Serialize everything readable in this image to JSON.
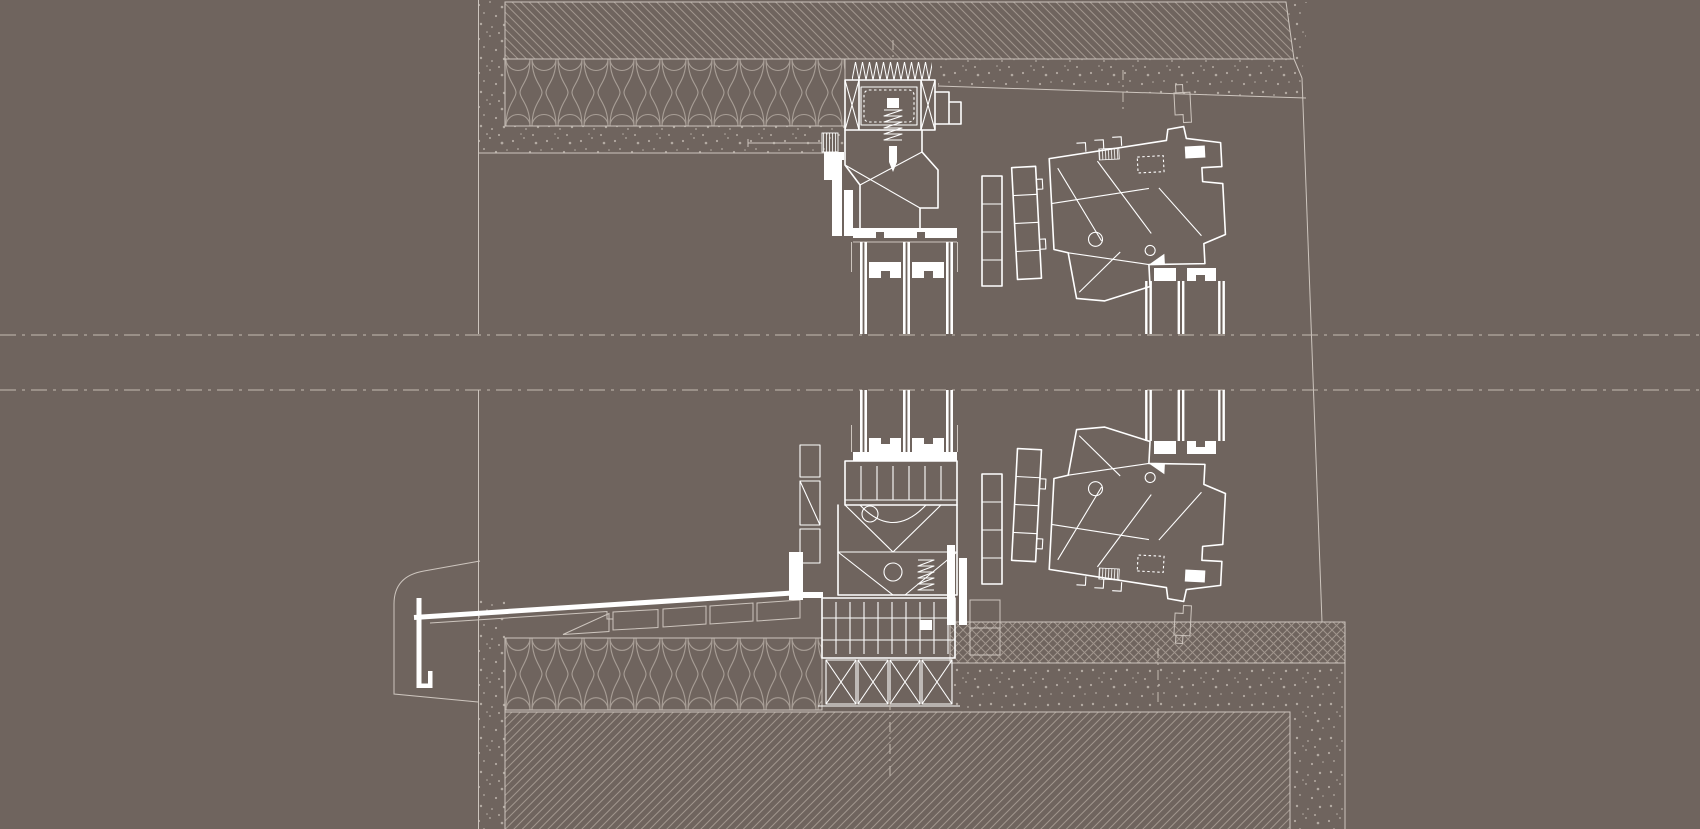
{
  "document": {
    "kind": "architectural-section-detail-drawing",
    "description": "Vertical section details of window installation: head (lintel) detail at top, sill detail at bottom, with a second tilted window profile detail at right; section break band across the middle. White CAD linework on brown background. No text labels visible.",
    "visible_text": []
  },
  "canvas": {
    "width": 1700,
    "height": 829,
    "viewBox": "0 0 1700 829"
  },
  "colors": {
    "bg": "#6f645e",
    "thin": "#cdc5be",
    "white": "#ffffff",
    "hatch": "#a1968d",
    "speck": "#b3aaa2",
    "dashc": "#c4bbb2",
    "insul": "#a89e96"
  },
  "components": {
    "wall_face_line_x": 478.5,
    "lintel": {
      "concrete_slab_hatched": [
        505,
        2,
        1294,
        59
      ],
      "thermal_insulation_band": [
        505,
        59,
        845,
        126
      ],
      "plaster_speckle_band": [
        479,
        126,
        845,
        153
      ],
      "sloped_soffit_speckle": [
        938,
        59,
        1306,
        98
      ]
    },
    "section_break_lines_y": [
      335,
      390
    ],
    "main_window": {
      "head_frame": [
        822,
        62,
        975,
        242
      ],
      "glazing_pane_centers_x": [
        863.5,
        906.5,
        949.5
      ],
      "glazing_runs_y": [
        [
          242,
          334
        ],
        [
          390,
          452
        ]
      ],
      "sill_frame": [
        789,
        438,
        977,
        658
      ],
      "subsill_frame": [
        822,
        598,
        955,
        706
      ]
    },
    "right_window": {
      "head_frame": [
        1014,
        88,
        1236,
        300
      ],
      "glazing_pane_centers_x": [
        1148.5,
        1181,
        1221.5
      ],
      "glazing_runs_y": [
        [
          272,
          334
        ],
        [
          390,
          441
        ]
      ],
      "sill_frame": [
        1014,
        428,
        1236,
        640
      ],
      "tilt_degrees": 3
    },
    "sill_flashing": {
      "from": [
        414,
        617
      ],
      "to": [
        800,
        592
      ],
      "drip_edge_x": 419,
      "end_cap": [
        393,
        560,
        480,
        702
      ]
    },
    "bottom_wall": {
      "insulation_band": [
        505,
        638,
        822,
        710
      ],
      "masonry_hatched": [
        505,
        712,
        1290,
        829
      ],
      "screed_crosshatch_band": [
        950,
        622,
        1345,
        663
      ],
      "speckle_band": [
        950,
        663,
        1345,
        829
      ]
    }
  }
}
